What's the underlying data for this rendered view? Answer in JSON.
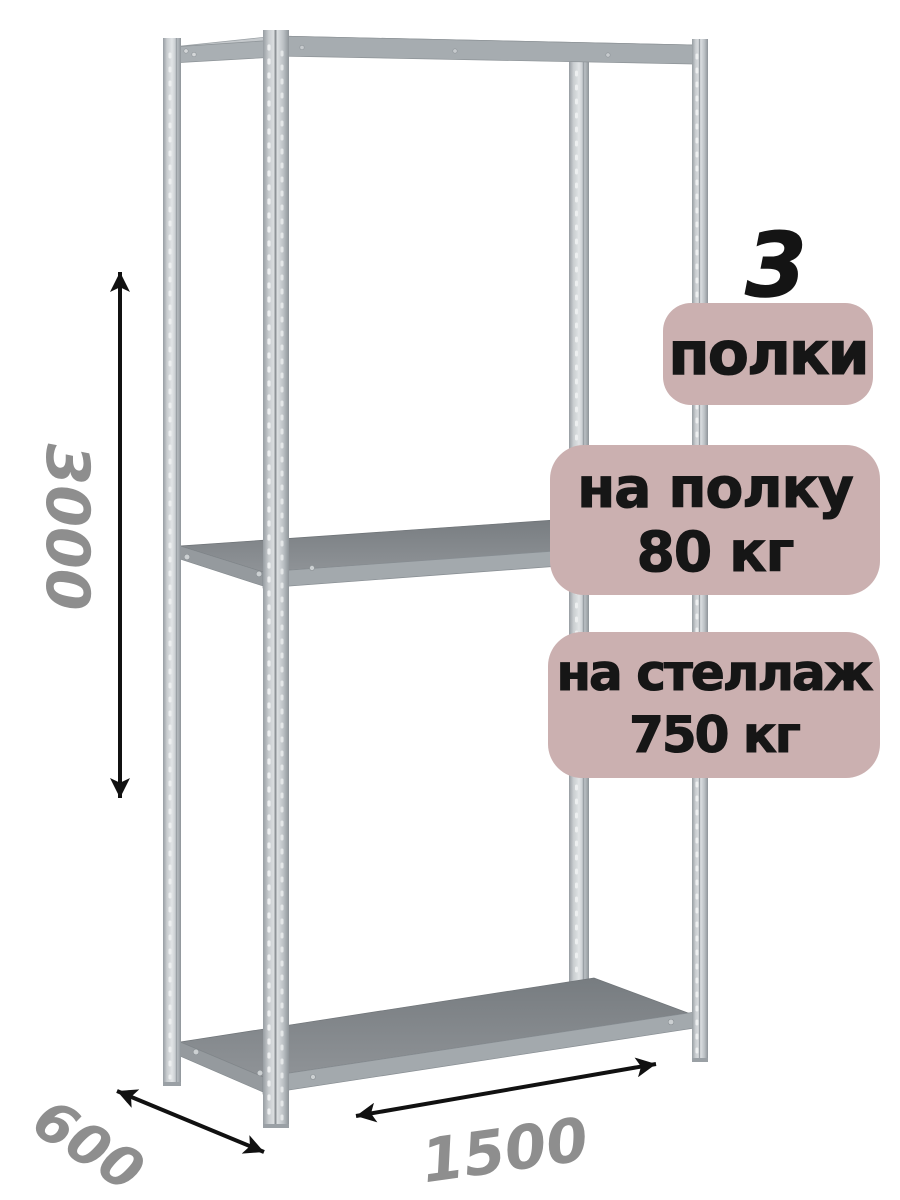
{
  "image": {
    "type": "product-render",
    "description": "metal boltless shelving rack with 3 shelves, isometric view on white background",
    "background_color": "#ffffff"
  },
  "rack": {
    "metal_color_light": "#e1e4e6",
    "metal_color_mid": "#b7bcc0",
    "shelf_top_color": "#84888c",
    "shelf_edge_color": "#a3a9ad"
  },
  "badges": {
    "background_color": "#cbb0b0",
    "text_color": "#161616",
    "shelf_count": {
      "number": "3",
      "label": "полки"
    },
    "shelf_load": {
      "line1": "на полку",
      "line2": "80 кг"
    },
    "rack_load": {
      "line1": "на стеллаж",
      "line2": "750 кг"
    }
  },
  "dimensions": {
    "height": "3000",
    "depth": "600",
    "width": "1500",
    "text_color": "#8e8e8e",
    "arrow_color": "#111111"
  }
}
